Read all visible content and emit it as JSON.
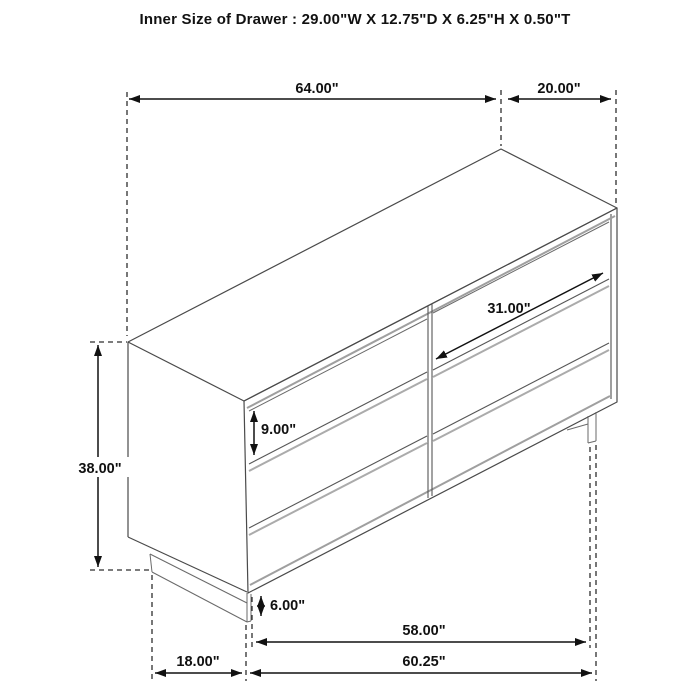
{
  "title": "Inner Size of Drawer : 29.00\"W X 12.75\"D X 6.25\"H X 0.50\"T",
  "dimensions": {
    "top_width": "64.00\"",
    "top_depth": "20.00\"",
    "overall_height": "38.00\"",
    "drawer_height": "9.00\"",
    "drawer_width": "31.00\"",
    "base_height": "6.00\"",
    "base_width": "58.00\"",
    "side_depth": "18.00\"",
    "overall_width": "60.25\""
  },
  "drawing": {
    "subject": "six-drawer dresser",
    "style": "technical line drawing, oblique front-left view",
    "drawer_columns": 2,
    "drawer_rows": 3
  },
  "colors": {
    "background": "#ffffff",
    "outline": "#4a4a4a",
    "trim": "#9f9f9f",
    "dimension": "#111111"
  }
}
